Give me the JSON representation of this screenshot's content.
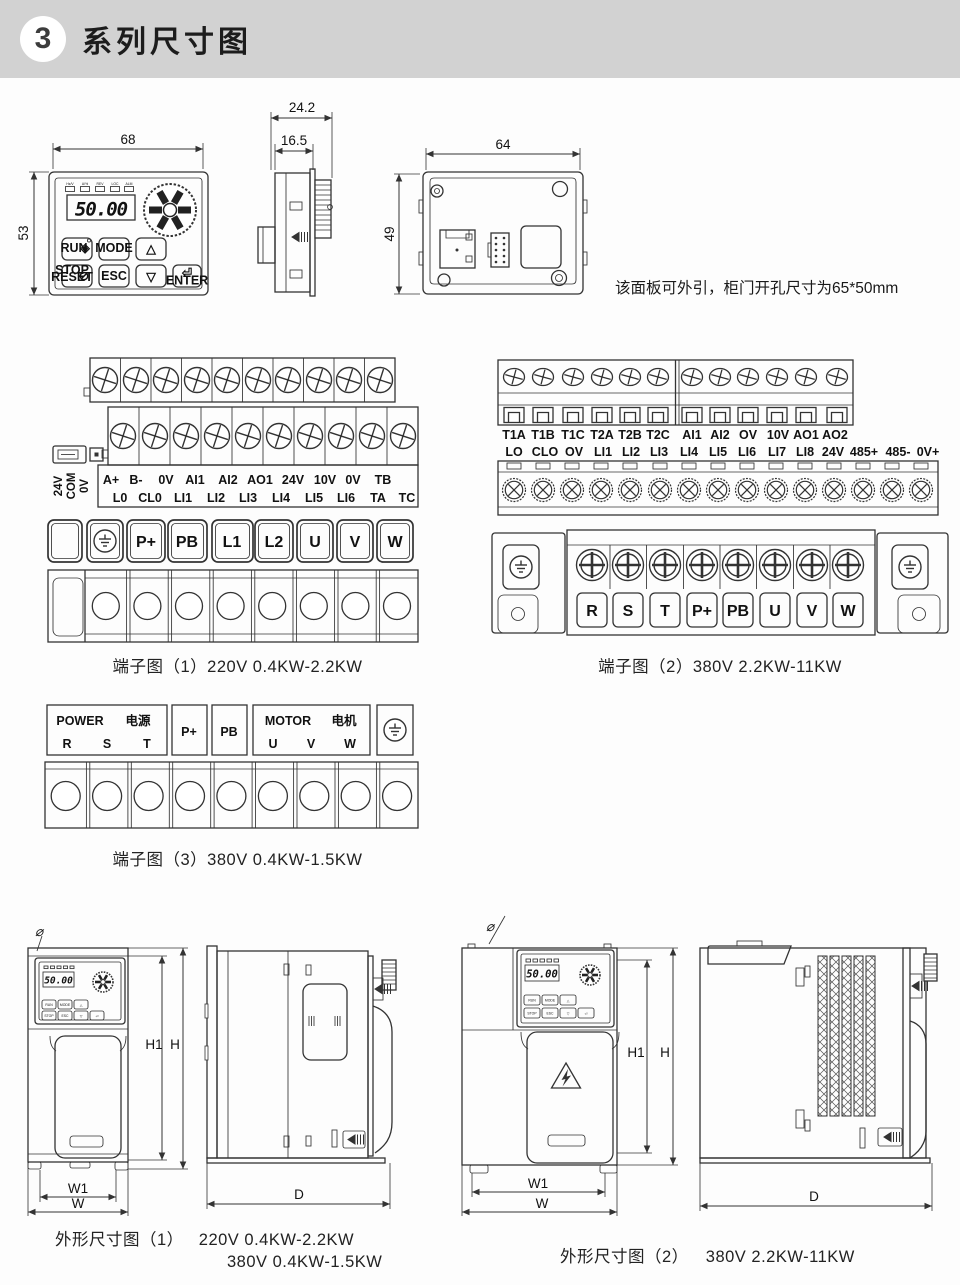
{
  "header": {
    "number": "3",
    "title": "系列尺寸图"
  },
  "panel": {
    "dim_width": "68",
    "dim_height": "53",
    "dim_depth": "24.2",
    "dim_depth_inner": "16.5",
    "dim_back_width": "64",
    "dim_back_height": "49",
    "display_value": "50.00",
    "led_labels": [
      "Hz/V",
      "A/%",
      "REV",
      "LOC",
      "ALM"
    ],
    "btn_run": "RUN",
    "run_icon": "◈",
    "btn_mode": "MODE",
    "btn_up": "△",
    "btn_stop1": "STOP",
    "btn_stop2": "RESET",
    "stop_icon": "⊘",
    "btn_esc": "ESC",
    "btn_down": "▽",
    "btn_enter": "ENTER",
    "enter_glyph": "⏎",
    "note": "该面板可外引，柜门开孔尺寸为65*50mm"
  },
  "terminal1": {
    "caption": "端子图（1）220V 0.4KW-2.2KW",
    "side_labels": [
      "24V",
      "COM",
      "0V"
    ],
    "row1": [
      "A+",
      "B-",
      "0V",
      "AI1",
      "AI2",
      "AO1",
      "24V",
      "10V",
      "0V",
      "TB"
    ],
    "row2": [
      "L0",
      "CL0",
      "LI1",
      "LI2",
      "LI3",
      "LI4",
      "LI5",
      "LI6",
      "TA",
      "TC"
    ],
    "power": [
      "P+",
      "PB",
      "L1",
      "L2",
      "U",
      "V",
      "W"
    ]
  },
  "terminal2": {
    "caption": "端子图（2）380V 2.2KW-11KW",
    "row1": [
      "T1A",
      "T1B",
      "T1C",
      "T2A",
      "T2B",
      "T2C",
      "AI1",
      "AI2",
      "OV",
      "10V",
      "AO1",
      "AO2"
    ],
    "row2": [
      "LO",
      "CLO",
      "OV",
      "LI1",
      "LI2",
      "LI3",
      "LI4",
      "LI5",
      "LI6",
      "LI7",
      "LI8",
      "24V",
      "485+",
      "485-",
      "0V+"
    ],
    "power": [
      "R",
      "S",
      "T",
      "P+",
      "PB",
      "U",
      "V",
      "W"
    ]
  },
  "terminal3": {
    "caption": "端子图（3）380V 0.4KW-1.5KW",
    "power_en": "POWER",
    "power_cn": "电源",
    "rst": [
      "R",
      "S",
      "T"
    ],
    "p_plus": "P+",
    "pb": "PB",
    "motor_en": "MOTOR",
    "motor_cn": "电机",
    "uvw": [
      "U",
      "V",
      "W"
    ]
  },
  "outline1": {
    "caption_label": "外形尺寸图（1）",
    "caption_spec1": "220V 0.4KW-2.2KW",
    "caption_spec2": "380V 0.4KW-1.5KW"
  },
  "outline2": {
    "caption_label": "外形尺寸图（2）",
    "caption_spec": "380V 2.2KW-11KW"
  },
  "dims": {
    "h1": "H1",
    "h": "H",
    "w1": "W1",
    "w": "W",
    "d": "D",
    "hole": "⌀"
  }
}
